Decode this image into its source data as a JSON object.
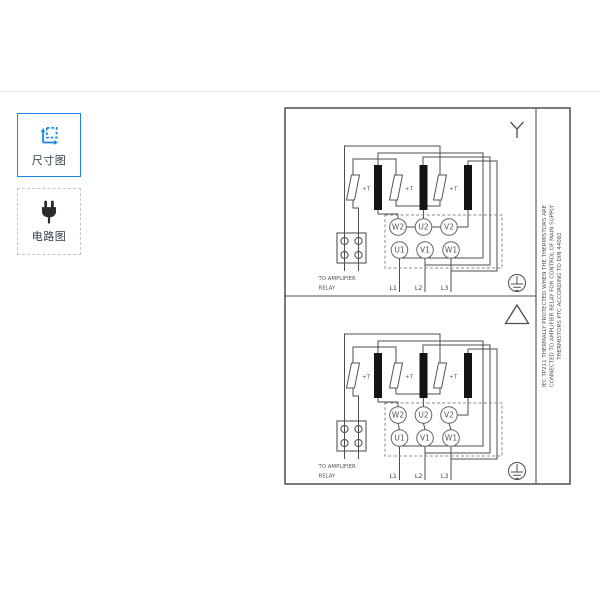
{
  "page": {
    "background": "#ffffff",
    "divider_color": "#ebebeb"
  },
  "sidebar": {
    "items": [
      {
        "id": "dimension-drawing",
        "label": "尺寸图",
        "icon": "dimension-icon",
        "selected": true,
        "accent": "#1e88e5"
      },
      {
        "id": "wiring-diagram",
        "label": "电路图",
        "icon": "plug-icon",
        "selected": false
      }
    ]
  },
  "diagram": {
    "wire_color": "#4d4d4d",
    "side_note_lines": [
      "IEC TP211 THERMALLY PROTECTED WHEN THE THERMISTORS ARE",
      "CONNECTED TO AMPLIFIER RELAY FOR CONTROL OF MAIN SUPPLY",
      "THERMISTORS PTC ACCORDING TO DIN 44082"
    ],
    "panels": [
      {
        "connection": "star",
        "connection_symbol": "Y",
        "thermistor_label": "+T",
        "terminals_top": [
          "W2",
          "U2",
          "V2"
        ],
        "terminals_bottom": [
          "U1",
          "V1",
          "W1"
        ],
        "supply_lines": [
          "L1",
          "L2",
          "L3"
        ],
        "relay_note_line1": "TO AMPLIFIER",
        "relay_note_line2": "RELAY"
      },
      {
        "connection": "delta",
        "connection_symbol": "△",
        "thermistor_label": "+T",
        "terminals_top": [
          "W2",
          "U2",
          "V2"
        ],
        "terminals_bottom": [
          "U1",
          "V1",
          "W1"
        ],
        "supply_lines": [
          "L1",
          "L2",
          "L3"
        ],
        "relay_note_line1": "TO AMPLIFIER",
        "relay_note_line2": "RELAY"
      }
    ]
  }
}
